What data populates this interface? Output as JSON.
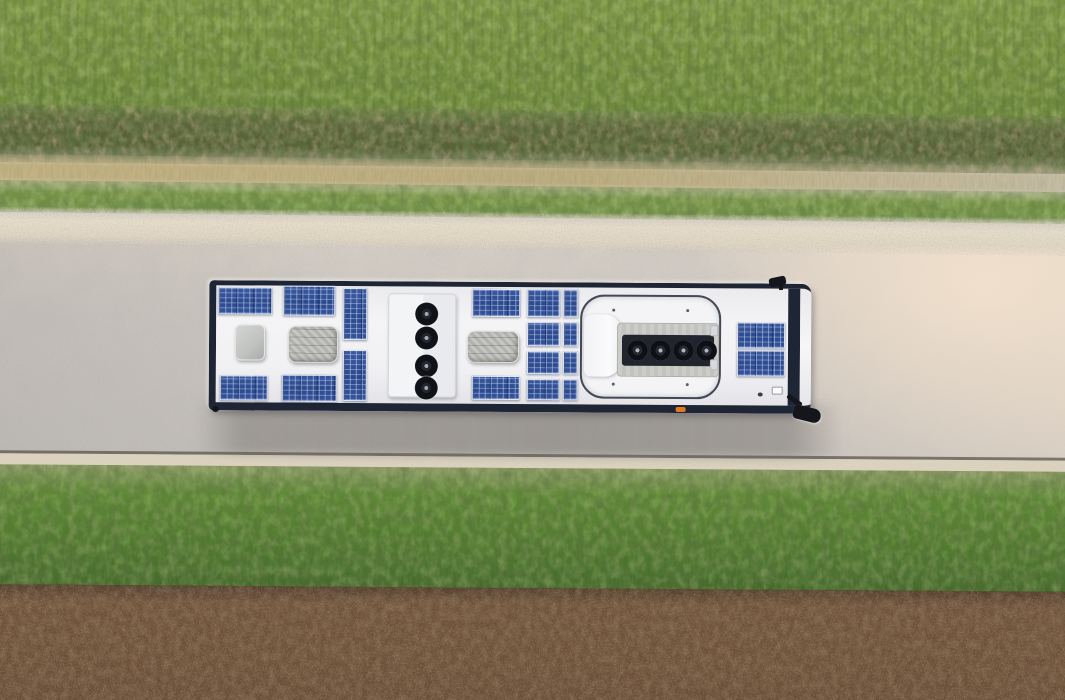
{
  "meta": {
    "type": "aerial-photograph",
    "subject": "Top-down drone view of a white electric bus with rooftop solar panels driving along a rural concrete road, flanked by grass verges, a hedgerow, a dry-grass strip and a brown ploughed field"
  },
  "scene": {
    "regions": {
      "top_field": "green crop field with row texture",
      "hedgerow": "dark green-brown scrub band",
      "dry_strip": "tan dried grass strip",
      "upper_verge": "green roadside verge",
      "gravel_shoulder": "light gravel road shoulder",
      "road": "light grey concrete road",
      "lower_verge": "green roadside grass strip",
      "ploughed_field": "brown soil field"
    },
    "bus": {
      "solar_panel_count": 18,
      "vertical_roof_fan_count": 4,
      "horizontal_roof_fan_count": 4,
      "ac_unit_count": 2,
      "roof_hatch_count": 2,
      "mirror_count": 2,
      "direction": "facing right",
      "shadow": "soft shadow cast below bus on road"
    }
  },
  "palette": {
    "grass_top": "#78943e",
    "grass_top_light": "#85a047",
    "hedge": "#5c6238",
    "dry_grass": "#c6b384",
    "verge_green": "#7e9a4b",
    "gravel": "#e5dcca",
    "road": "#cdc8c2",
    "road_edge": "#5b564d",
    "verge_bottom": "#5d8c33",
    "soil": "#6f5139",
    "bus_border": "#1e2534",
    "bus_roof": "#f4f4f6",
    "solar_blue": "#2b4a8e",
    "equip_gray": "#bcbdb9",
    "hatch_outline": "#434853",
    "accent_orange": "#e07a20"
  }
}
